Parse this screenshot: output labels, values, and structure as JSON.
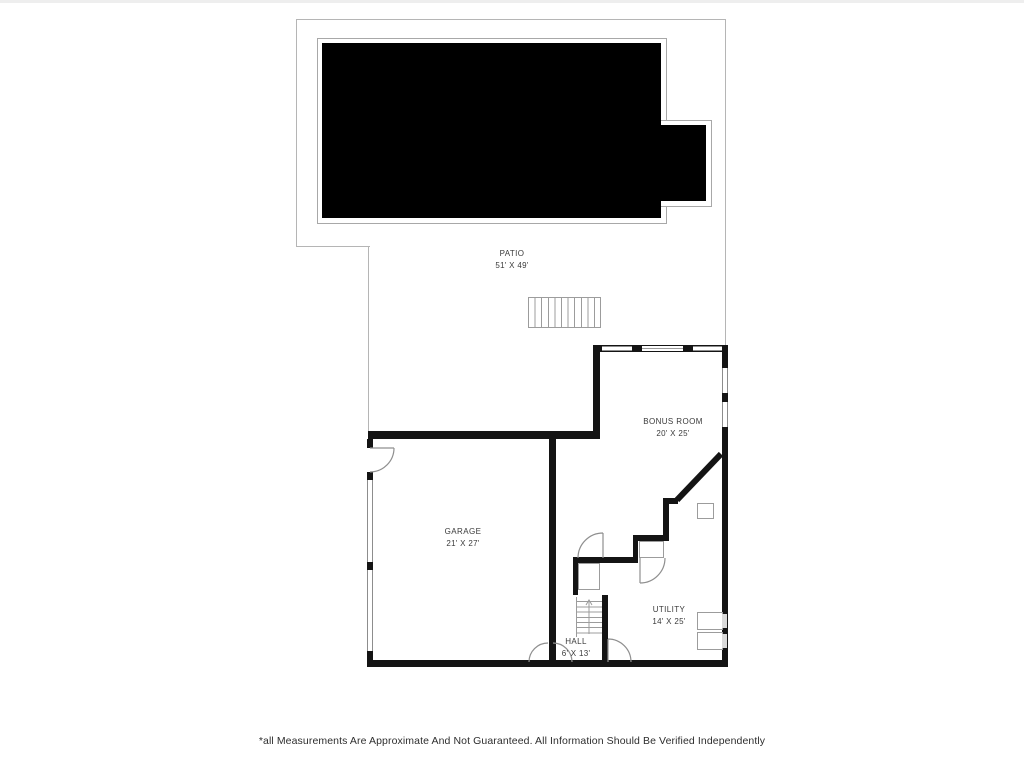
{
  "floor_plan": {
    "rooms": [
      {
        "name": "PATIO",
        "dims": "51' X 49'"
      },
      {
        "name": "BONUS ROOM",
        "dims": "20' X 25'"
      },
      {
        "name": "GARAGE",
        "dims": "21' X 27'"
      },
      {
        "name": "UTILITY",
        "dims": "14' X 25'"
      },
      {
        "name": "HALL",
        "dims": "6' X 13'"
      }
    ],
    "footer_disclaimer": "*all Measurements Are Approximate And Not Guaranteed. All Information Should Be Verified Independently",
    "colors": {
      "wall": "#141414",
      "pool_fill": "#000000",
      "thin_outline": "#9c9c9c",
      "patio_outline": "#b5b5b5",
      "label_text": "#3a3a3a"
    },
    "features": {
      "pool": "filled black rectangle with right-side alcove",
      "deck_stairs_treads": 11,
      "hall_stairs_treads": 8
    }
  }
}
